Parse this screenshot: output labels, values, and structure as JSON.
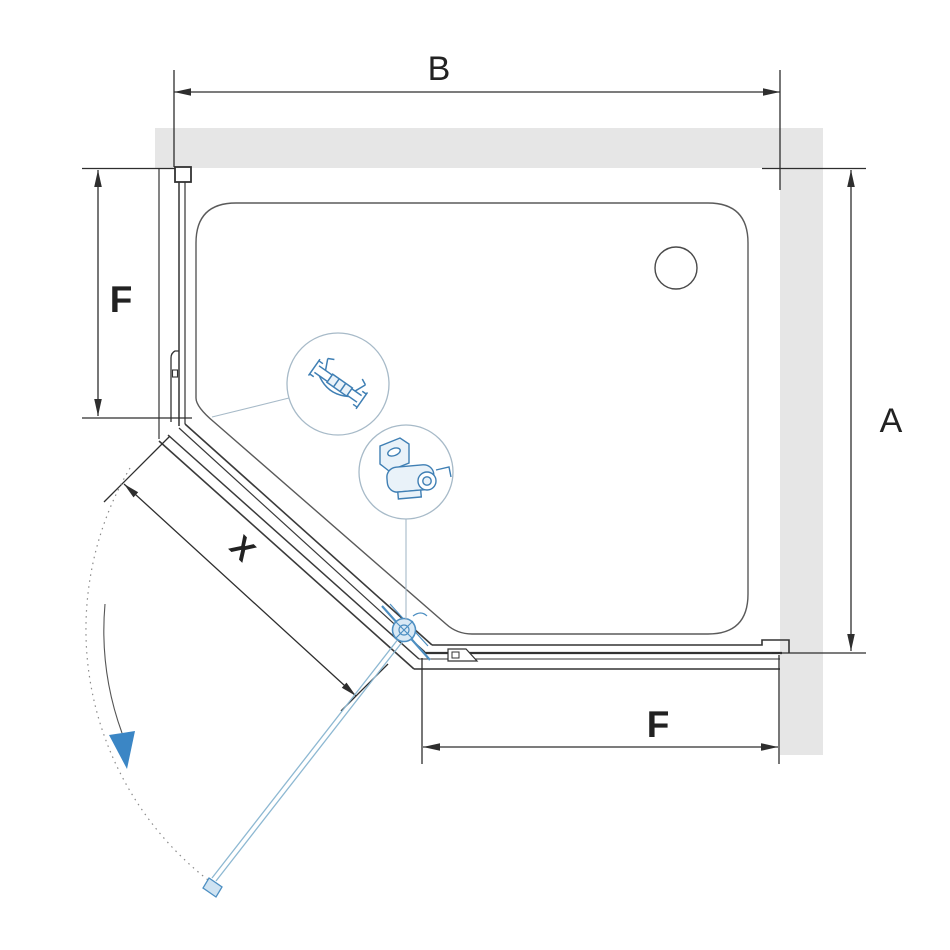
{
  "diagram": {
    "title": "shower-enclosure-top-view-installation-diagram",
    "dimensions": {
      "width_top": "B",
      "height_right": "A",
      "side_left_panel": "F",
      "side_bottom_panel": "F",
      "door_diagonal": "X"
    },
    "details": {
      "detail_1": "wall-profile-cross-section",
      "detail_2": "pivot-bracket-hardware"
    },
    "colors": {
      "wall_gray": "#e6e6e6",
      "line_dark": "#333333",
      "tray_line": "#5a5a5a",
      "accent_blue": "#4489c2",
      "light_blue": "#9dc2da",
      "blue_fill": "#e2eef7",
      "callout_gray_blue": "#a7bac8"
    }
  }
}
